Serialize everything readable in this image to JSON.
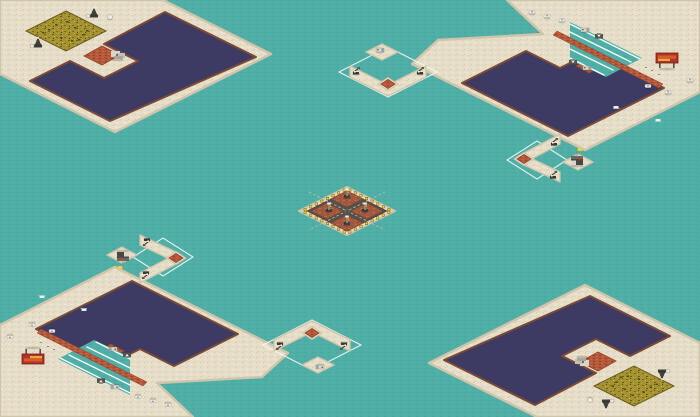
{
  "meta": {
    "description": "Isometric RTS skirmish map overview: teal sea, four corner sand islands with navy pools, ore fields, dock ramps, four civilian outposts with start-position markers, central oil-derrick platform",
    "symmetry": "180-degree point symmetry about map center",
    "size": {
      "w": 700,
      "h": 417
    }
  },
  "palette": {
    "water": "#4FAFA7",
    "waterSpeck": "#4BA8A0",
    "waterSpeck2": "#53B4AC",
    "sand": "#E6DEC9",
    "sandDark": "#DCD2BB",
    "sandLight": "#EFE8D7",
    "sandDot": "#D2C7AC",
    "coast": "#CFC5AB",
    "pool": "#3D3B63",
    "poolBorder": "#7B4A35",
    "brick": "#B5593A",
    "brickLight": "#C46847",
    "brickDark": "#96432B",
    "ore": "#A59331",
    "oreDark": "#6A5D20",
    "oreDot": "#55491A",
    "oreLight": "#C6B54E",
    "terra": "#A55A3F",
    "terraLight": "#B5694C",
    "terraDark": "#8E4C36",
    "road": "#54504B",
    "roadStripe": "#BDB7AC",
    "light": "#F2D141",
    "lightEdge": "#7A5E10",
    "marker": "#F4F7F2",
    "unitDark": "#3B3935",
    "unitMid": "#56524C",
    "unitGray": "#8F8A80",
    "unitWhite": "#F0EFE8",
    "flagYellow": "#E8D23C",
    "billboardRed": "#B43226",
    "billboardOrange": "#D85A2E",
    "billboardYellow": "#E2AC3E",
    "ruinLight": "#D8D6CC",
    "ruinMid": "#C2C0B6",
    "ruinDark": "#A9A79D",
    "wake": "#7FD0C8"
  },
  "islands": {
    "topLeft": {
      "name": "island-top-left",
      "outline": [
        [
          0,
          0
        ],
        [
          163,
          0
        ],
        [
          271,
          54
        ],
        [
          115,
          132
        ],
        [
          0,
          74
        ]
      ],
      "pool": [
        [
          165,
          12
        ],
        [
          256,
          57
        ],
        [
          110,
          121
        ],
        [
          30,
          81
        ],
        [
          70,
          61
        ],
        [
          104,
          78
        ],
        [
          138,
          61
        ],
        [
          104,
          44
        ]
      ],
      "ramp": [
        [
          84,
          56
        ],
        [
          102,
          46
        ],
        [
          120,
          55
        ],
        [
          102,
          65
        ]
      ],
      "ore": {
        "cx": 66,
        "cy": 31,
        "hw": 40
      },
      "sprites": [
        {
          "t": "ruin",
          "x": 118,
          "y": 56
        },
        {
          "t": "pump",
          "x": 94,
          "y": 14
        },
        {
          "t": "tank",
          "x": 110,
          "y": 17
        },
        {
          "t": "pump",
          "x": 38,
          "y": 44
        }
      ]
    },
    "topRight": {
      "name": "island-top-right",
      "outline": [
        [
          507,
          0
        ],
        [
          700,
          0
        ],
        [
          700,
          92
        ],
        [
          585,
          150
        ],
        [
          412,
          64
        ],
        [
          438,
          40
        ],
        [
          543,
          34
        ]
      ],
      "pool": [
        [
          560,
          36
        ],
        [
          664,
          88
        ],
        [
          568,
          136
        ],
        [
          462,
          83
        ],
        [
          526,
          51
        ],
        [
          560,
          68
        ],
        [
          594,
          51
        ]
      ],
      "ramp": [
        [
          576,
          66
        ],
        [
          589,
          59
        ],
        [
          602,
          66
        ],
        [
          589,
          73
        ]
      ],
      "docks": {
        "basin": [
          [
            570,
            22
          ],
          [
            642,
            58
          ],
          [
            606,
            77
          ],
          [
            570,
            60
          ]
        ],
        "lines": [
          [
            570,
            24,
            640,
            59
          ],
          [
            570,
            32,
            631,
            62
          ],
          [
            570,
            41,
            622,
            67
          ],
          [
            570,
            49,
            613,
            70
          ],
          [
            570,
            58,
            604,
            75
          ]
        ]
      },
      "bricks": [
        [
          [
            557,
            31
          ],
          [
            663,
            84
          ],
          [
            659,
            88
          ],
          [
            553,
            35
          ]
        ]
      ],
      "sprites": [
        {
          "t": "car",
          "x": 532,
          "y": 12
        },
        {
          "t": "car",
          "x": 547,
          "y": 16
        },
        {
          "t": "car",
          "x": 562,
          "y": 20
        },
        {
          "t": "truck",
          "x": 585,
          "y": 30
        },
        {
          "t": "darkUnit",
          "x": 599,
          "y": 36
        },
        {
          "t": "darkUnit",
          "x": 573,
          "y": 62
        },
        {
          "t": "truck",
          "x": 587,
          "y": 68
        },
        {
          "t": "billboard",
          "x": 667,
          "y": 60
        },
        {
          "t": "person",
          "x": 652,
          "y": 72
        },
        {
          "t": "person",
          "x": 659,
          "y": 76
        },
        {
          "t": "person",
          "x": 646,
          "y": 69
        },
        {
          "t": "car",
          "x": 648,
          "y": 86
        },
        {
          "t": "car",
          "x": 668,
          "y": 92
        },
        {
          "t": "car",
          "x": 690,
          "y": 80
        },
        {
          "t": "boat",
          "x": 616,
          "y": 107
        },
        {
          "t": "boat",
          "x": 658,
          "y": 120
        }
      ]
    }
  },
  "outposts": {
    "top": {
      "name": "outpost-top",
      "marker": {
        "cx": 388,
        "cy": 72,
        "hw": 49,
        "hh": 25
      },
      "chevrons": [
        [
          [
            350,
            66
          ],
          [
            388,
            85
          ],
          [
            426,
            66
          ],
          [
            426,
            77
          ],
          [
            388,
            96
          ],
          [
            350,
            77
          ]
        ]
      ],
      "tilePatch": {
        "cx": 388,
        "cy": 84,
        "hw": 10,
        "hh": 6.5
      },
      "tile": {
        "cx": 388,
        "cy": 84,
        "hw": 7,
        "hh": 4.5
      },
      "platform": {
        "cx": 382,
        "cy": 52,
        "hw": 16,
        "hh": 8
      },
      "sprites": [
        {
          "t": "pumpjack",
          "x": 356,
          "y": 72
        },
        {
          "t": "pumpjack",
          "x": 420,
          "y": 72
        },
        {
          "t": "truck",
          "x": 380,
          "y": 50
        }
      ]
    },
    "right": {
      "name": "outpost-right",
      "marker": {
        "cx": 537,
        "cy": 160,
        "hw": 30,
        "hh": 19
      },
      "chevrons": [
        [
          [
            560,
            134
          ],
          [
            560,
            144
          ],
          [
            522,
            164
          ],
          [
            522,
            154
          ]
        ],
        [
          [
            522,
            154
          ],
          [
            522,
            164
          ],
          [
            560,
            182
          ],
          [
            560,
            172
          ]
        ]
      ],
      "tilePatch": {
        "cx": 524,
        "cy": 159,
        "hw": 10,
        "hh": 6.5
      },
      "tile": {
        "cx": 524,
        "cy": 159,
        "hw": 7,
        "hh": 4.5
      },
      "platform": {
        "cx": 578,
        "cy": 162,
        "hw": 15,
        "hh": 8
      },
      "sprites": [
        {
          "t": "pumpjack",
          "x": 554,
          "y": 143
        },
        {
          "t": "pumpjack",
          "x": 553,
          "y": 176
        },
        {
          "t": "flagBuilding",
          "x": 577,
          "y": 160
        }
      ]
    }
  },
  "central": {
    "name": "central-oil-platform",
    "cx": 347,
    "cy": 211,
    "hw": 48,
    "hh": 24,
    "innerHw": 40,
    "lightsPerEdge": 8,
    "quadHw": 16,
    "quads": [
      {
        "cx": 347,
        "cy": 199
      },
      {
        "cx": 367,
        "cy": 211
      },
      {
        "cx": 347,
        "cy": 223
      },
      {
        "cx": 327,
        "cy": 211
      }
    ],
    "derricks": [
      [
        347,
        196
      ],
      [
        329,
        210
      ],
      [
        365,
        210
      ],
      [
        347,
        223
      ]
    ],
    "stripes": [
      [
        309,
        192,
        385,
        230
      ],
      [
        385,
        192,
        309,
        230
      ]
    ],
    "oreBlobOffsets": [
      [
        -18,
        -2
      ],
      [
        -6,
        6
      ],
      [
        8,
        -4
      ],
      [
        16,
        3
      ],
      [
        0,
        -10
      ],
      [
        -11,
        -7
      ],
      [
        5,
        9
      ],
      [
        20,
        -1
      ],
      [
        -24,
        1
      ],
      [
        12,
        8
      ]
    ]
  }
}
